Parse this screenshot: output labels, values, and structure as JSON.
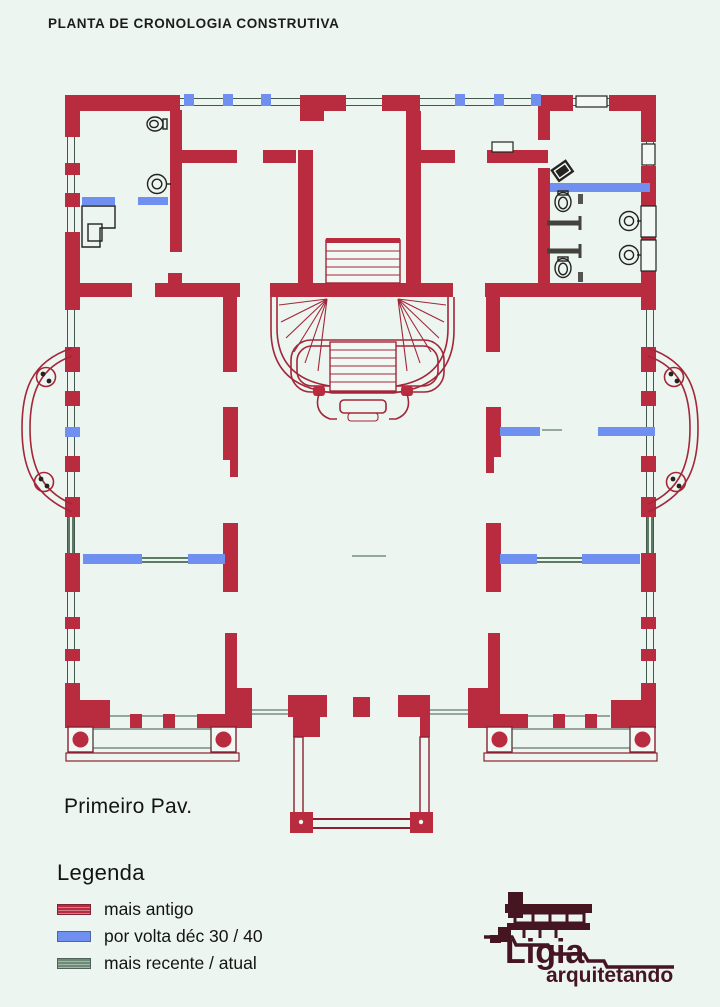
{
  "page": {
    "title": "PLANTA DE CRONOLOGIA CONSTRUTIVA",
    "floor_label": "Primeiro Pav."
  },
  "legend": {
    "heading": "Legenda",
    "items": [
      {
        "label": "mais antigo",
        "color": "#b92b3e"
      },
      {
        "label": "por volta déc 30 / 40",
        "color": "#6f8ff1"
      },
      {
        "label": "mais recente / atual",
        "color": "#6d8a77"
      }
    ]
  },
  "logo": {
    "name": "Ligia",
    "tagline": "arquitetando",
    "color": "#451622"
  },
  "colors": {
    "wall_oldest": "#b92b3e",
    "wall_dec3040": "#6f8ff1",
    "wall_recent": "#5d7a64",
    "background": "#ecf5ef",
    "ink": "#1d1d1b",
    "logo": "#451622"
  }
}
